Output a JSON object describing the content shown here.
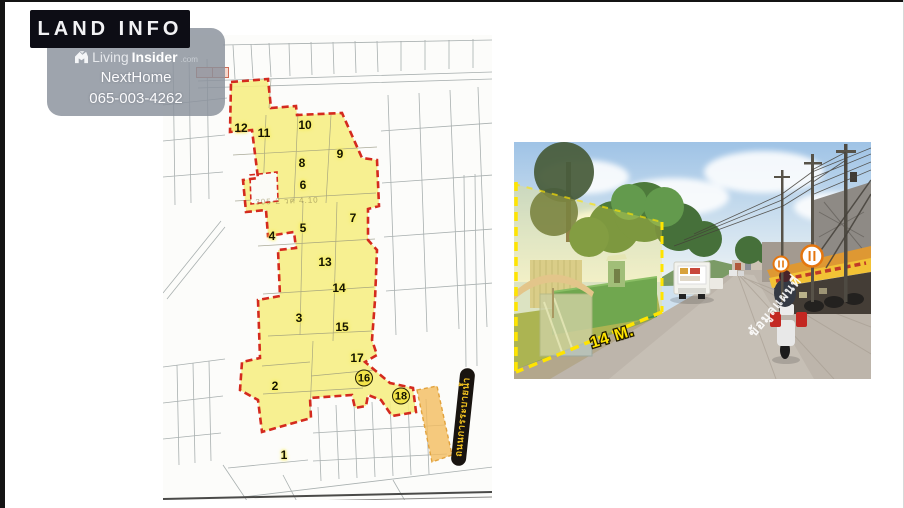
{
  "page": {
    "background": "#ffffff",
    "frame_color": "#141414"
  },
  "header": {
    "title": "LAND INFO"
  },
  "watermark": {
    "brand": "Living",
    "brand_bold": "Insider",
    "brand_suffix": ".com",
    "agent_name": "NextHome",
    "phone": "065-003-4262"
  },
  "map": {
    "parcels": [
      "1",
      "2",
      "3",
      "4",
      "5",
      "6",
      "7",
      "8",
      "9",
      "10",
      "11",
      "12",
      "13",
      "14",
      "15",
      "16",
      "17",
      "18"
    ],
    "stamp_note": "305-2 วค 4.10",
    "road_label": "ถนนการระบายน้ำ",
    "colors": {
      "highlight": "#f6ee82",
      "boundary": "#d42a1e",
      "road_strip": "#f2bc5e",
      "parcel_line": "#9aa2a2"
    }
  },
  "photo": {
    "frontage_label": "14 M.",
    "road_text": "ข้อมูลแผนที่",
    "colors": {
      "outline": "#ffe400",
      "overlay": "#ffe84a"
    }
  }
}
